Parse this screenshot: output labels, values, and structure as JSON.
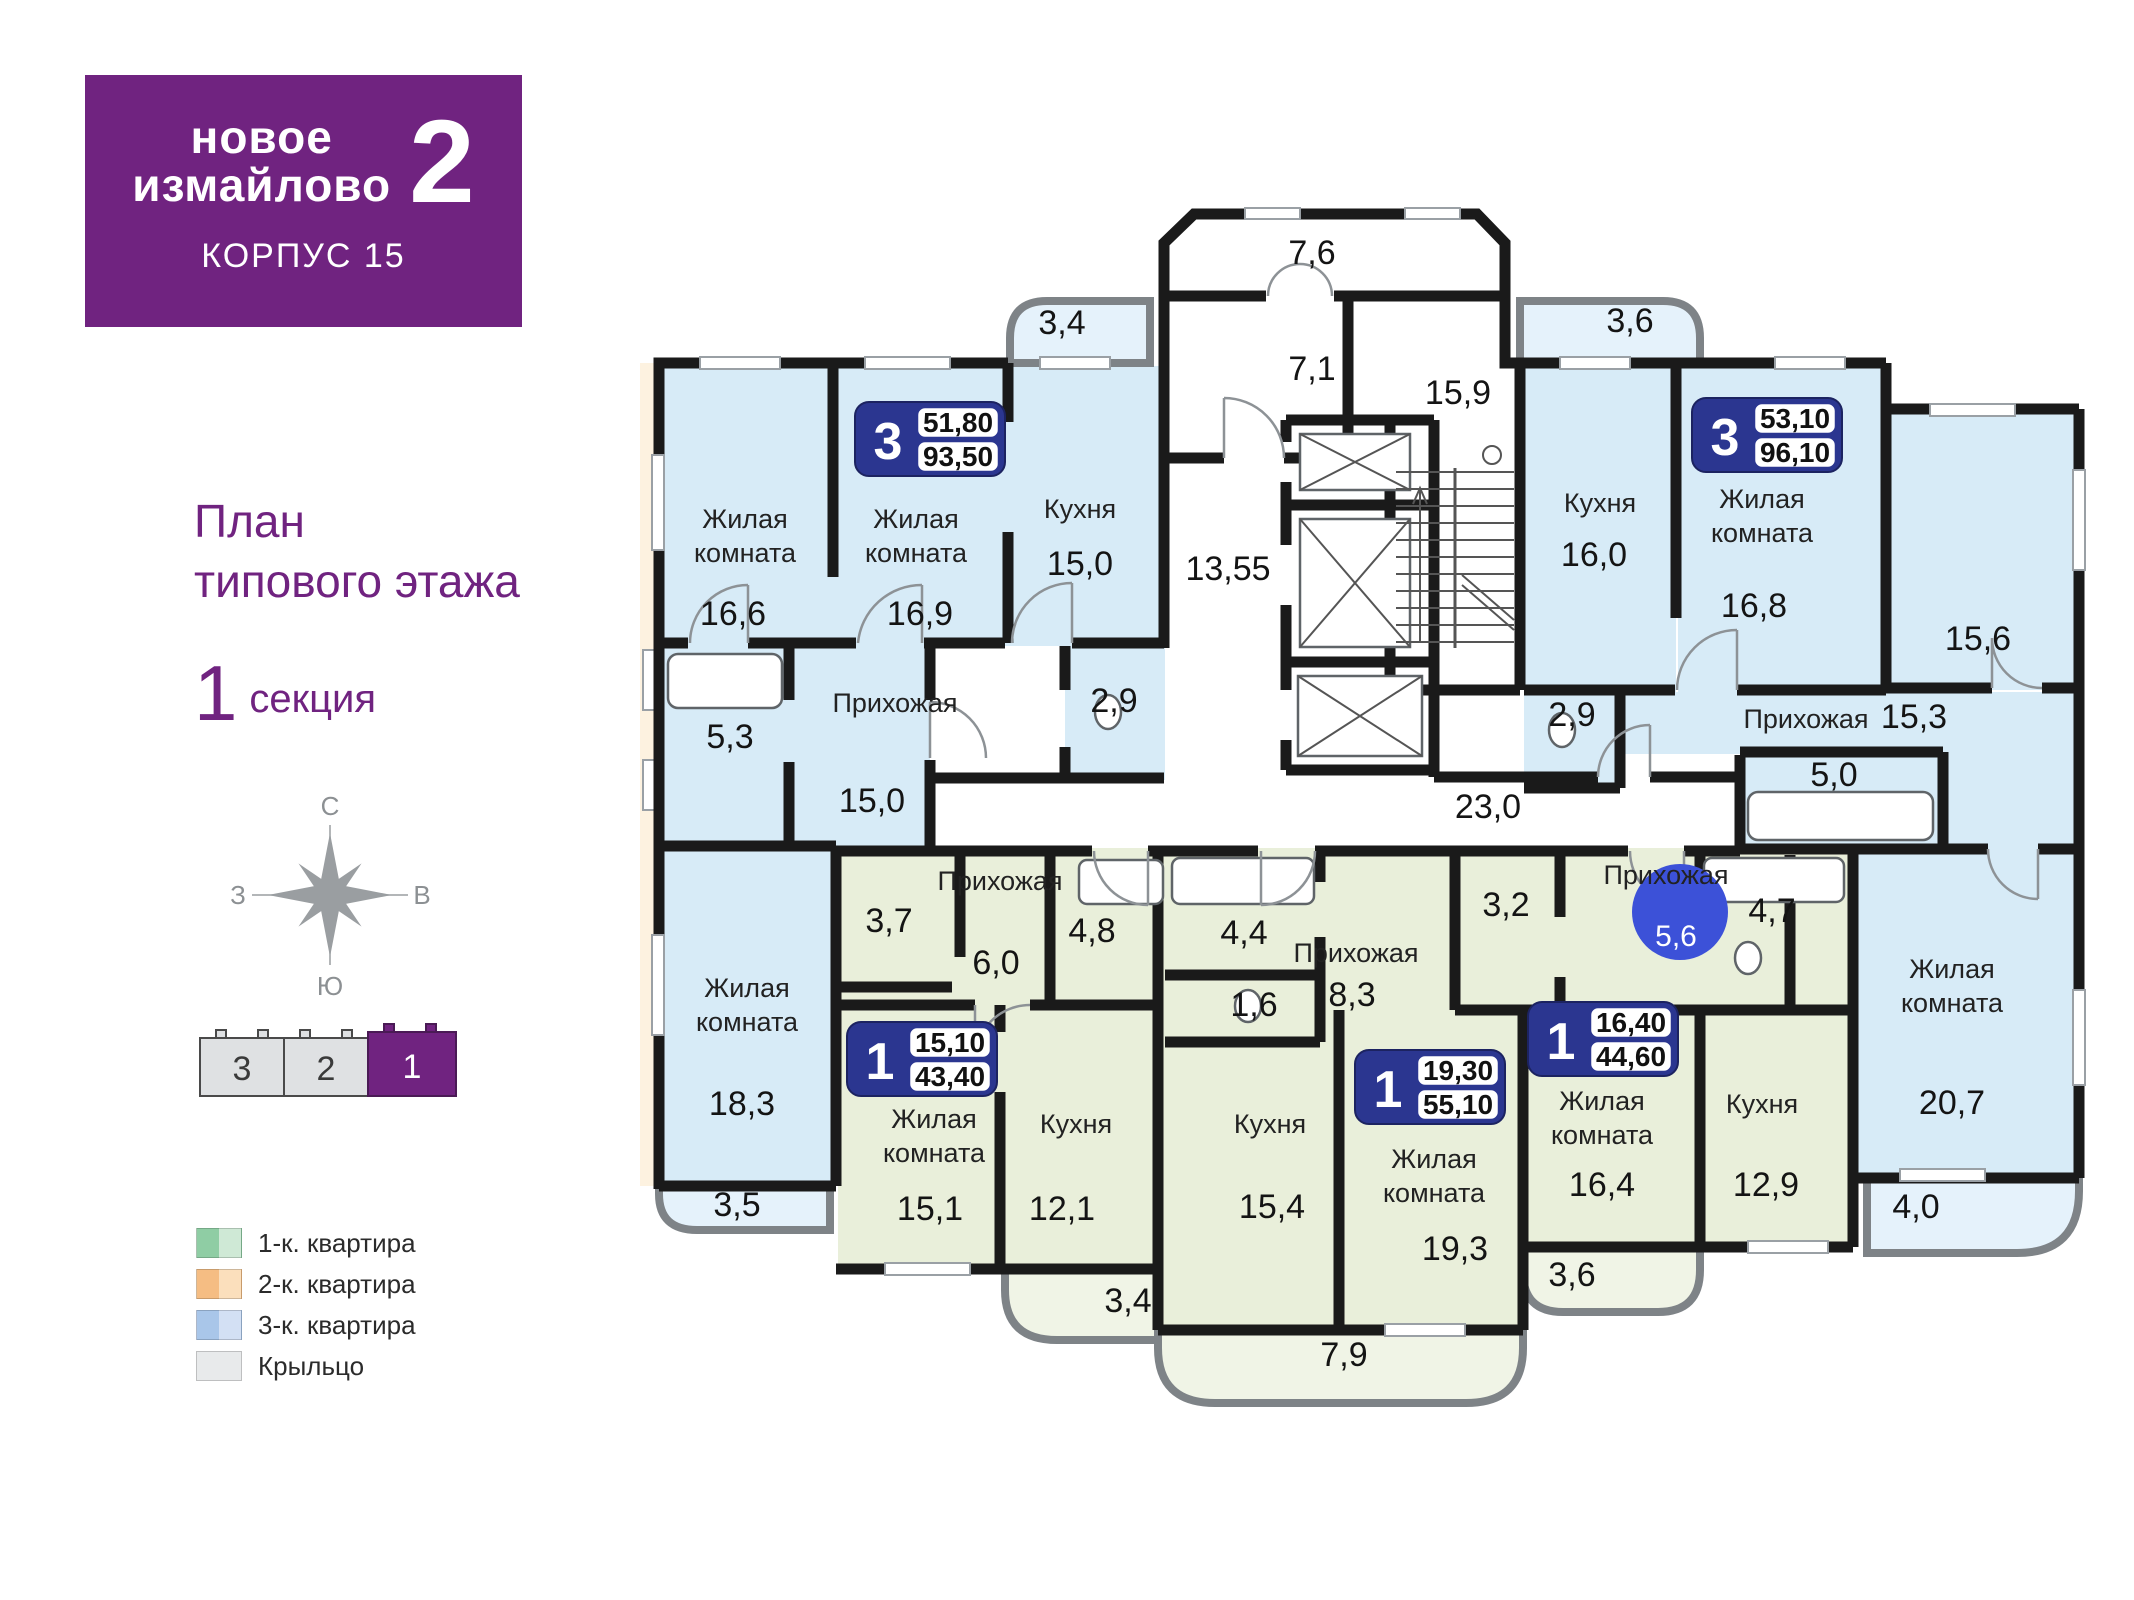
{
  "logo": {
    "brand_line1": "новое",
    "brand_line2": "измайлово",
    "brand_number": "2",
    "building": "корпус 15"
  },
  "titles": {
    "plan_line1": "План",
    "plan_line2": "типового этажа",
    "section_number": "1",
    "section_word": "секция"
  },
  "compass": {
    "n": "С",
    "s": "Ю",
    "w": "З",
    "e": "В"
  },
  "minimap": {
    "sections": [
      "3",
      "2",
      "1"
    ]
  },
  "legend": [
    {
      "label": "1-к. квартира"
    },
    {
      "label": "2-к. квартира"
    },
    {
      "label": "3-к. квартира"
    },
    {
      "label": "Крыльцо"
    }
  ],
  "words": {
    "living1": "Жилая",
    "living2": "комната",
    "kitchen": "Кухня",
    "hallway": "Прихожая"
  },
  "core": {
    "vestibule": "7,6",
    "hall": "7,1",
    "stairs": "15,9",
    "corridor_vertical": "13,55",
    "corridor_horizontal": "23,0"
  },
  "apartments": {
    "a3_left": {
      "type": "3",
      "living": "51,80",
      "total": "93,50",
      "room1": "16,6",
      "room2": "16,9",
      "kitchen": "15,0",
      "hallway": "15,0",
      "bath": "5,3",
      "wc": "2,9",
      "room3": "18,3",
      "balcony_top": "3,4",
      "balcony_bottom": "3,5"
    },
    "a3_right": {
      "type": "3",
      "living": "53,10",
      "total": "96,10",
      "kitchen": "16,0",
      "room1": "16,8",
      "room2": "15,6",
      "hallway": "15,3",
      "bath": "5,0",
      "wc": "2,9",
      "room3": "20,7",
      "balcony_top": "3,6",
      "balcony_bottom": "4,0"
    },
    "a1_left": {
      "type": "1",
      "living": "15,10",
      "total": "43,40",
      "wardrobe": "3,7",
      "hallway": "6,0",
      "bath": "4,8",
      "room": "15,1",
      "kitchen": "12,1",
      "balcony": "3,4"
    },
    "a1_mid": {
      "type": "1",
      "living": "19,30",
      "total": "55,10",
      "bath": "4,4",
      "wc": "1,6",
      "hallway": "8,3",
      "kitchen": "15,4",
      "room": "19,3",
      "balcony": "7,9"
    },
    "a1_right": {
      "type": "1",
      "living": "16,40",
      "total": "44,60",
      "wardrobe": "3,2",
      "hallway": "5,6",
      "bath": "4,7",
      "room": "16,4",
      "kitchen": "12,9",
      "balcony": "3,6"
    }
  },
  "colors": {
    "purple": "#702380",
    "badge_navy": "#2b3690",
    "highlight_blue": "#3c51d8",
    "room_blue": "#d7ebf7",
    "room_green": "#e9efda",
    "balcony_blue": "#e5f2fb",
    "balcony_green": "#f0f4e6"
  }
}
